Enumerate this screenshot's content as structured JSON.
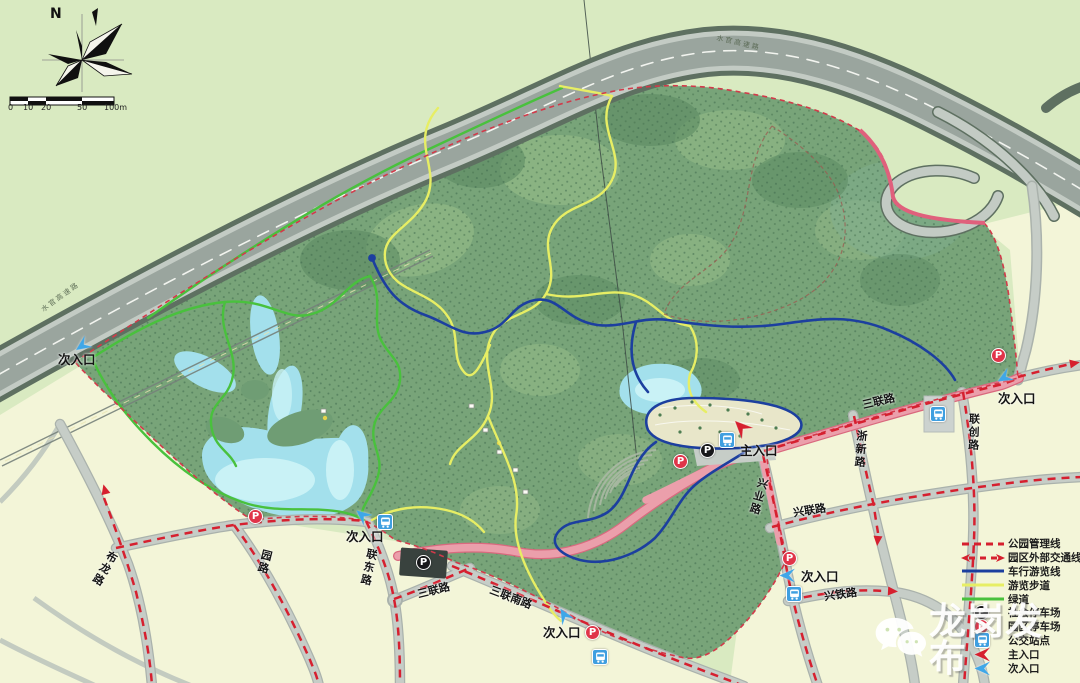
{
  "compass": {
    "north_label": "N"
  },
  "scale_bar": {
    "ticks": [
      "0",
      "10",
      "20",
      "50",
      "100m"
    ]
  },
  "roads": {
    "bulong": "布龙路",
    "yuanlu": "园路",
    "liandong": "联东路",
    "sanlian": "三联路",
    "sanlian_south": "三联南路",
    "lianchuang": "联创路",
    "zhexin": "浙新路",
    "xingye": "兴业路",
    "xinglian": "兴联路",
    "xingtie": "兴铁路",
    "expressway": "水官高速路"
  },
  "entrances": {
    "main": "主入口",
    "secondary": "次入口"
  },
  "legend": {
    "items": [
      {
        "label": "公园管理线",
        "type": "line-dashed-red"
      },
      {
        "label": "园区外部交通线",
        "type": "line-dashed-red-arrows"
      },
      {
        "label": "车行游览线",
        "type": "line-blue"
      },
      {
        "label": "游览步道",
        "type": "line-yellow"
      },
      {
        "label": "绿道",
        "type": "line-green"
      },
      {
        "label": "社会停车场",
        "type": "parking-black"
      },
      {
        "label": "园区停车场",
        "type": "parking-red"
      },
      {
        "label": "公交站点",
        "type": "bus-stop"
      },
      {
        "label": "主入口",
        "type": "arrow-red"
      },
      {
        "label": "次入口",
        "type": "arrow-blue"
      }
    ]
  },
  "icons": {
    "parking_letter": "P"
  },
  "watermark": {
    "text": "龙岗发布"
  },
  "colors": {
    "park_boundary": "#d23a4a",
    "external_traffic": "#d6202f",
    "car_route": "#1c3f9f",
    "footpath": "#e7ee64",
    "greenway": "#49c13d",
    "lake": "#a3e0ec",
    "forest": "#78a479"
  }
}
